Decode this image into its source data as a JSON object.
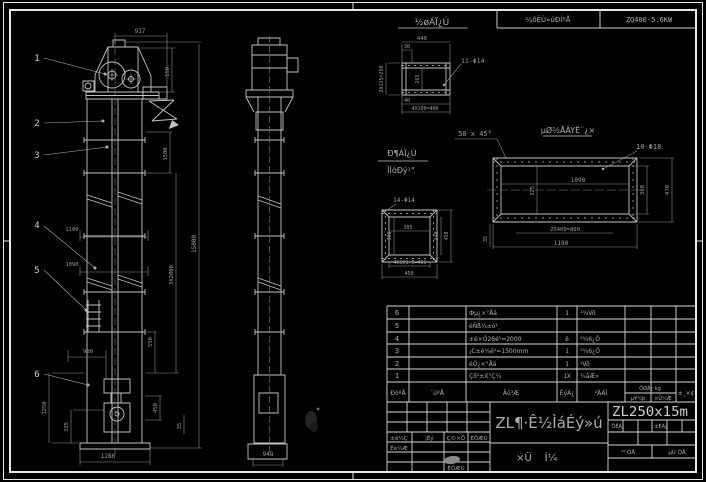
{
  "header_strip": {
    "label": "¼õËÙ»úÐÍºÅ",
    "value": "ZQ400-5.6KW"
  },
  "front_view": {
    "balloons": [
      "1",
      "2",
      "3",
      "4",
      "5",
      "6"
    ],
    "dims": {
      "top": "917",
      "head_h": "150",
      "upper": "1500",
      "sections": "3X2000",
      "overall": "15000",
      "mid_w1": "1100",
      "mid_w2": "1090",
      "boot_top": "900",
      "boot_h": "1250",
      "boot_lower": "325",
      "base_w": "1286",
      "right1": "550",
      "right2": "450",
      "right3": "35"
    }
  },
  "side_view": {
    "dims": {
      "base_w": "948"
    }
  },
  "detail_inlet": {
    "title": "½øÁÏ¿Ú",
    "dims": {
      "w": "440",
      "offset": "30",
      "left": "2X125=250",
      "inner_h": "265",
      "holes": "11-Φ14",
      "foot": "40",
      "pitch": "4X100=400"
    }
  },
  "chamfer_note": "50 x 45°",
  "detail_outlet": {
    "title_top": "Ð¶ÁÏ¿Ú",
    "title_bottom": "ÎÍóÐý¹°",
    "holes": "14-Φ14",
    "dims": {
      "w": "305",
      "h": "300",
      "right_inner": "340",
      "right": "450",
      "pitch": "4X101.5=406",
      "base": "450"
    }
  },
  "detail_base": {
    "title": "µØ½ÅÂÝË¨¿×",
    "holes": "10-Φ18",
    "dims": {
      "inner_w": "1098",
      "inner_h": "325",
      "right_inner": "360",
      "right": "470",
      "pitch": "2X400=800",
      "w": "1190",
      "left": "35"
    }
  },
  "parts": {
    "rows": [
      {
        "no": "6",
        "name": "Фµ¿×°Åä",
        "qty": "1",
        "mat": "¹¾Võ"
      },
      {
        "no": "5",
        "name": "éÑß¼±ó¹¸",
        "qty": "",
        "mat": ""
      },
      {
        "no": "4",
        "name": "±é×Ó26é¹=2000",
        "qty": "6",
        "mat": "¹¾6¿Õ"
      },
      {
        "no": "3",
        "name": "¡C±é¾é¹=1500mm",
        "qty": "1",
        "mat": "¹¾6¿Õ"
      },
      {
        "no": "2",
        "name": "éÒ¿×°Åä",
        "qty": "1",
        "mat": "¹Võ"
      },
      {
        "no": "1",
        "name": "Çõ¹±X°Ç¼",
        "qty": "1X",
        "mat": "¼åÆ»"
      }
    ],
    "header": {
      "no": "ÐòºÅ",
      "code": "´úºÅ",
      "name": "Ãû³Æ",
      "qty": "ÊýÁ¿",
      "mat": "²ÄÁÏ",
      "weight": "ÖØÁ¿ kg",
      "w1": "µ¥¼þ",
      "w2": "×Ü¼Æ",
      "note": "±¸×¢"
    }
  },
  "title_block": {
    "rev": {
      "mark": "±ê¼Ç",
      "count": "´¦Êý",
      "sign": "Ç©×Ö",
      "date": "ÈÕÆÚ"
    },
    "design_label": "Éè¼Æ",
    "date_label": "ÈÕÆÚ",
    "title_main": "ZL¶·Ê½ÌáÉý»ú",
    "subtitle_1": "×Ü",
    "subtitle_2": "Í¼",
    "model": "ZL250x15m",
    "mass_label": "ÖÊÁ¿",
    "scale_label": "±ÈÀý",
    "sheet_total": "¹² ÕÅ",
    "sheet_no": "µÚ ÕÅ"
  }
}
